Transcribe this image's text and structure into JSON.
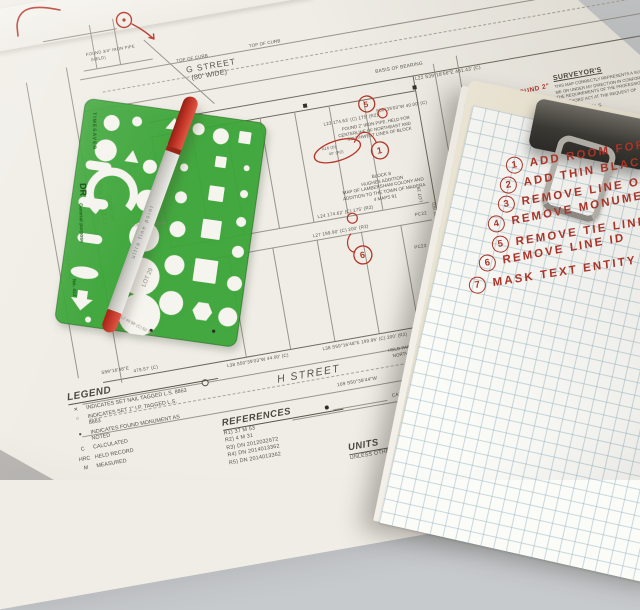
{
  "scene": {
    "description": "Desk with survey parcel map, green drafting template, red marker pen and a clipboard checklist"
  },
  "colors": {
    "desk": "#c7cacd",
    "paper": "#f0ede6",
    "map_line": "#98948a",
    "map_ink": "#57544a",
    "red_ink": "#b5362a",
    "template_green": "#3aa636",
    "pen_red": "#c0392b",
    "pen_body": "#d8d7d3",
    "board_cream": "#eae4d2",
    "grid_blue": "#c6d6dc",
    "clip_metal": "#3a3935",
    "wire_silver": "#b7b5ae"
  },
  "map": {
    "g_street": {
      "name": "G STREET",
      "width": "(80' WIDE)"
    },
    "h_street": {
      "name": "H STREET"
    },
    "side_streets": {
      "left_name": "7TH STREET",
      "left_width": "(80' WIDE)",
      "right_name": "MILL STREET",
      "right_lot": "LOT 16"
    },
    "curb_label": "TOP OF CURB",
    "basis": "BASIS OF BEARING",
    "dims": {
      "l22": "L22 S39°18'56\"E  461.43' (C)",
      "l23": "L23 174.63' (C) 175' (R2)",
      "d40": "S50°39'03\"W  40.00' (C)",
      "l24": "L24 174.62' (C) 175' (R2)",
      "l27": "L27 199.90' (C) 200' (R2)",
      "l38a": "L38 S50°39'03\"W  44.00' (C)",
      "l38b": "L38 S59°16'48\"E  199.95' (C) 200' (R2)",
      "d479": "479.57' (C)",
      "s59": "S59°16'48\"E",
      "d109": "109 S50°38'44\"W",
      "caltrans": "CAL TRANS MON -",
      "v1": "L10 S50°38'09\"W  150.00' (R2)",
      "v2": "S50°38'25\"W  150.00' (C)",
      "v3": "301.37' (C)",
      "pc22": "PC22",
      "pc23": "PC23"
    },
    "found34": "FOUND 3/4\" IRON PIPE",
    "held": "(HELD)",
    "found2": [
      "FOUND 2\" IRON PIPE, HELD FOR",
      "CENTERLINE OF NORTHEAST AND",
      "SOUTHWEST LINES OF BLOCK"
    ],
    "block_note": [
      "BLOCK 8",
      "HUGHES ADDITION",
      "MAP OF LAMBERSHAM COLONY AND",
      "ADDITION TO THE TOWN OF MADERA",
      "4 MAPS 91"
    ],
    "held_parallel": [
      "HELD PARALLEL TO",
      "NORTHEAST SIDE",
      "OF BLOCK"
    ],
    "legend": {
      "title": "LEGEND",
      "items": [
        {
          "sym": "✕",
          "text": "INDICATES SET NAIL TAGGED L.S. 8863"
        },
        {
          "sym": "○",
          "text": "INDICATES SET 1\" I.P. TAGGED L.S. 8863"
        },
        {
          "sym": "●",
          "text": "INDICATES FOUND MONUMENT AS NOTED"
        },
        {
          "sym": "C",
          "text": "CALCULATED"
        },
        {
          "sym": "HRC",
          "text": "HELD RECORD"
        },
        {
          "sym": "M",
          "text": "MEASURED"
        }
      ]
    },
    "references": {
      "title": "REFERENCES",
      "rows": [
        "R1)  37 M 53",
        "R2)  4 M 31",
        "R3)  DN 2012032672",
        "R4)  DN 2014013362",
        "R5)  DN 2014013362"
      ]
    },
    "units": {
      "title": "UNITS",
      "line": "UNLESS OTHE"
    },
    "surveyor": {
      "title": "SURVEYOR'S",
      "lines": [
        "THIS MAP CORRECTLY REPRESENTS A SURVEY",
        "ME OR UNDER MY DIRECTION IN CONFORMANCE",
        "THE REQUIREMENTS OF THE PROFESSIONAL LAND",
        "SURVEYORS' ACT AT THE REQUEST OF"
      ],
      "name": "ALEX CALDER, P.L.S."
    },
    "annotations": {
      "n1": "1",
      "n5": "5",
      "n6": "6",
      "cloud_line1": "A16 (D)",
      "cloud_line2": "40' (R2)",
      "note": "NOW FOUND 2\""
    }
  },
  "template": {
    "brand": "TIMESAVER",
    "logo": "DR",
    "series": "General purpose",
    "model": "No. 422",
    "see_through": [
      "LOT 29",
      "COUNTY MADERA",
      "L7 49.98' (C) 50' (R2)"
    ]
  },
  "pen": {
    "label": "ultra fine point"
  },
  "checklist": [
    {
      "num": "1",
      "text": "ADD ROOM FOR S"
    },
    {
      "num": "2",
      "text": "ADD THIN BLACK L"
    },
    {
      "num": "3",
      "text": "REMOVE LINE ON"
    },
    {
      "num": "4",
      "text": "REMOVE MONUMEN"
    },
    {
      "num": "5",
      "text": "REMOVE TIE LINE"
    },
    {
      "num": "6",
      "text": "REMOVE LINE ID"
    },
    {
      "num": "7",
      "text": "MASK TEXT ENTITY"
    }
  ]
}
